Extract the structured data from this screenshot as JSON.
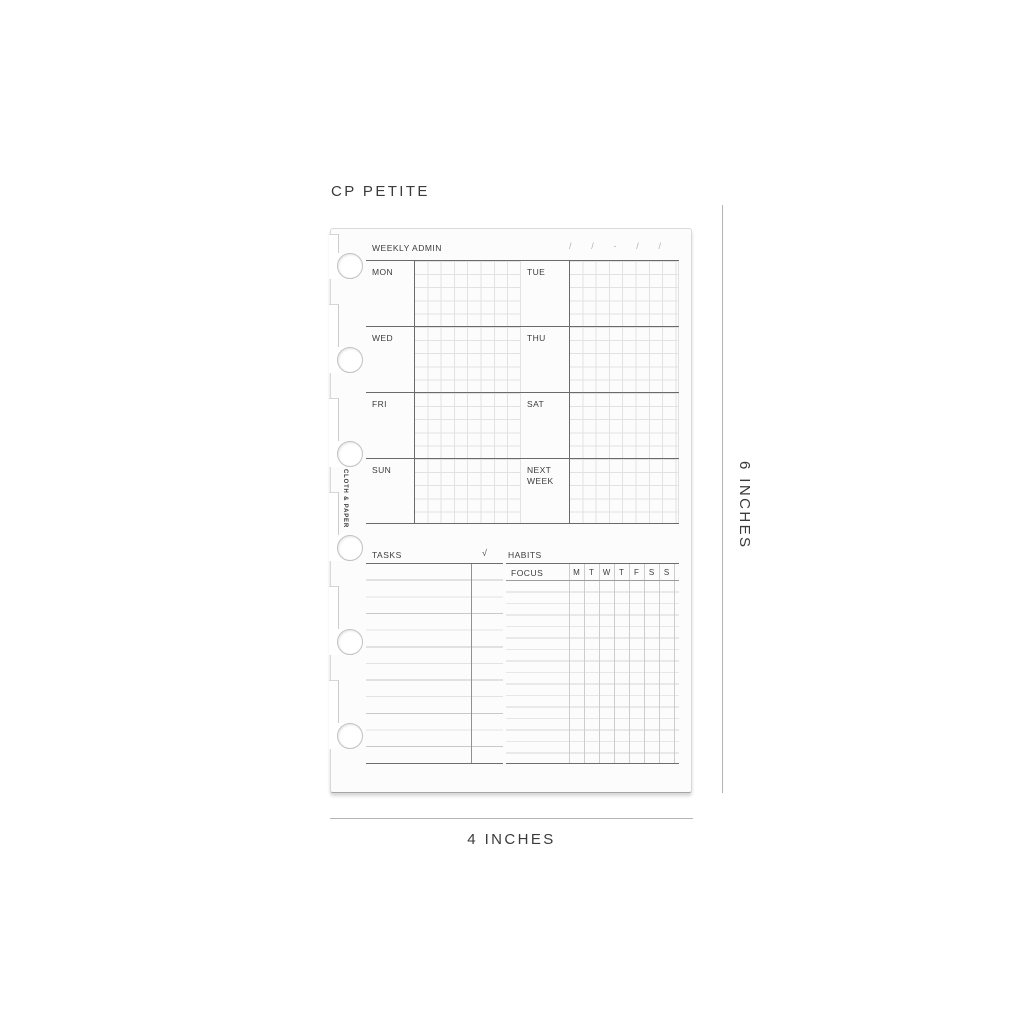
{
  "title": "CP PETITE",
  "brand_vertical": "CLOTH & PAPER",
  "weekly": {
    "header": "WEEKLY ADMIN",
    "date_tokens": [
      "/",
      "/",
      "-",
      "/",
      "/"
    ],
    "days": [
      "MON",
      "TUE",
      "WED",
      "THU",
      "FRI",
      "SAT",
      "SUN",
      "NEXT WEEK"
    ]
  },
  "tasks": {
    "label": "TASKS",
    "check_symbol": "√"
  },
  "habits": {
    "label": "HABITS",
    "focus_label": "FOCUS",
    "day_initials": [
      "M",
      "T",
      "W",
      "T",
      "F",
      "S",
      "S"
    ]
  },
  "dimensions": {
    "width_label": "4 INCHES",
    "height_label": "6 INCHES"
  },
  "colors": {
    "section_line_dark": "#6a6a6a",
    "grid_line_light": "#e2e2e2",
    "label_text": "#3c3c3c",
    "dimension_line": "#b5b5b5",
    "page_background": "#fcfcfc"
  }
}
